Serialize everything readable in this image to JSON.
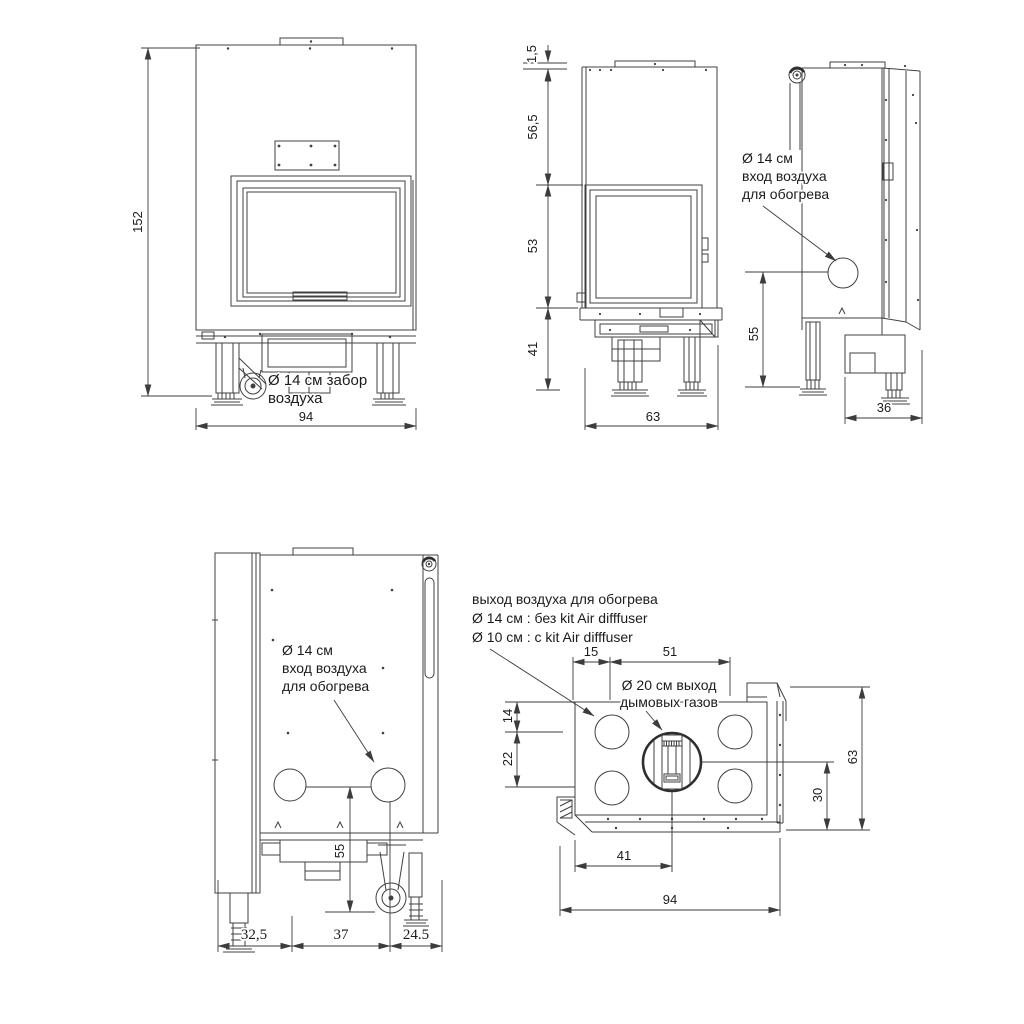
{
  "document": {
    "type": "fireplace insert dimensional drawing",
    "units": "cm",
    "colors": {
      "background": "#ffffff",
      "line": "#404040",
      "text": "#1b1b1b"
    }
  },
  "views": {
    "front": {
      "height_dim": "152",
      "width_dim": "94",
      "air_intake_label_1": "Ø 14 см забор",
      "air_intake_label_2": "воздуха"
    },
    "side_left": {
      "thickness_dim": "1,5",
      "upper_dim": "56,5",
      "middle_dim": "53",
      "lower_dim": "41",
      "depth_dim": "63"
    },
    "side_right": {
      "air_inlet_label_1": "Ø 14 см",
      "air_inlet_label_2": "вход воздуха",
      "air_inlet_label_3": "для обогрева",
      "inlet_height_dim": "55",
      "depth_dim": "36"
    },
    "rear": {
      "air_inlet_label_1": "Ø 14 см",
      "air_inlet_label_2": "вход воздуха",
      "air_inlet_label_3": "для обогрева",
      "inlet_height_dim": "55",
      "bottom_dims": [
        "32,5",
        "37",
        "24.5"
      ]
    },
    "top": {
      "air_outlet_label_1": "выход воздуха для обогрева",
      "air_outlet_label_2": "Ø 14 см : без kit Air difffuser",
      "air_outlet_label_3": "Ø 10 см : с kit Air difffuser",
      "flue_label_1": "Ø 20 см выход",
      "flue_label_2": "дымовых газов",
      "offset_dim": "15",
      "span_dim": "51",
      "left_upper_dim": "14",
      "left_lower_dim": "22",
      "right_inner_dim": "30",
      "right_outer_dim": "63",
      "bottom_inner_dim": "41",
      "bottom_outer_dim": "94"
    }
  }
}
